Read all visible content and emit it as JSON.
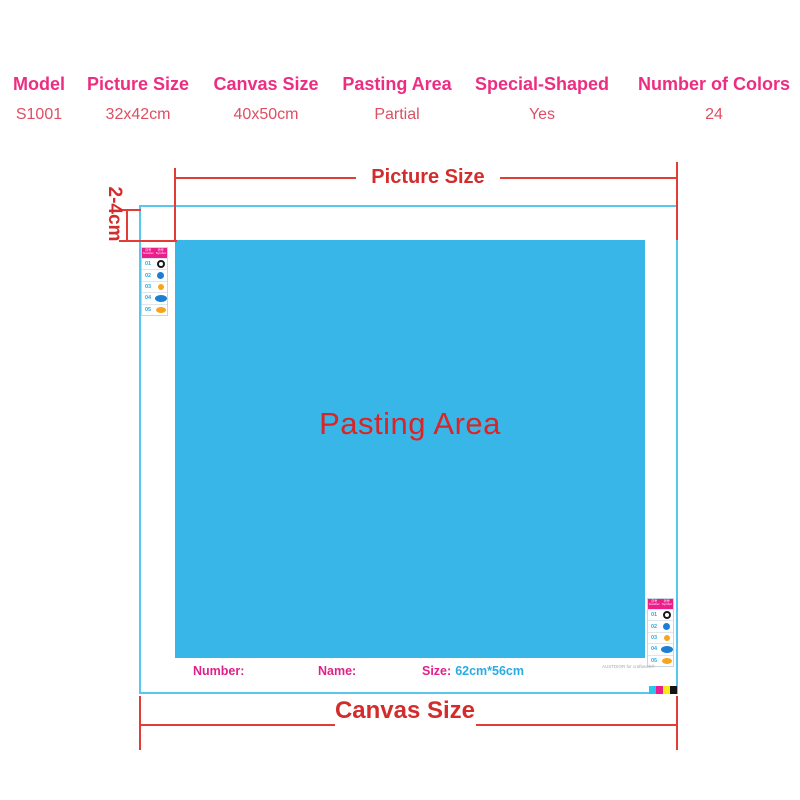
{
  "table": {
    "columns": [
      {
        "header": "Model",
        "value": "S1001"
      },
      {
        "header": "Picture Size",
        "value": "32x42cm"
      },
      {
        "header": "Canvas Size",
        "value": "40x50cm"
      },
      {
        "header": "Pasting Area",
        "value": "Partial"
      },
      {
        "header": "Special-Shaped",
        "value": "Yes"
      },
      {
        "header": "Number of Colors",
        "value": "24"
      }
    ]
  },
  "diagram": {
    "picture_size_label": "Picture Size",
    "canvas_size_label": "Canvas Size",
    "margin_label": "2-4cm",
    "pasting_area_label": "Pasting Area",
    "footer": {
      "number_label": "Number:",
      "name_label": "Name:",
      "size_label": "Size:",
      "size_value": "62cm*56cm"
    },
    "legend": {
      "header_col1": "序号",
      "header_col1_sub": "Number",
      "header_col2": "符号",
      "header_col2_sub": "Symbol",
      "rows": [
        {
          "num": "01",
          "symbol": "black-donut"
        },
        {
          "num": "02",
          "symbol": "blue-circle"
        },
        {
          "num": "03",
          "symbol": "orange-circle"
        },
        {
          "num": "04",
          "symbol": "blue-oval"
        },
        {
          "num": "05",
          "symbol": "orange-oval"
        }
      ]
    },
    "fine_print": "AUSTDIOR for craftwork®",
    "color_bar": [
      "#29c4f0",
      "#ec1e8c",
      "#f7ec13",
      "#141414"
    ]
  },
  "colors": {
    "table_header_pink": "#ed2d82",
    "table_value_red": "#df4e63",
    "dimension_red": "#e23c36",
    "canvas_border_cyan": "#57c7ef",
    "pasting_blue": "#39b6e8",
    "footer_magenta": "#e0218a",
    "size_value_cyan": "#29abe2",
    "legend_header_magenta": "#ec1e8c"
  }
}
